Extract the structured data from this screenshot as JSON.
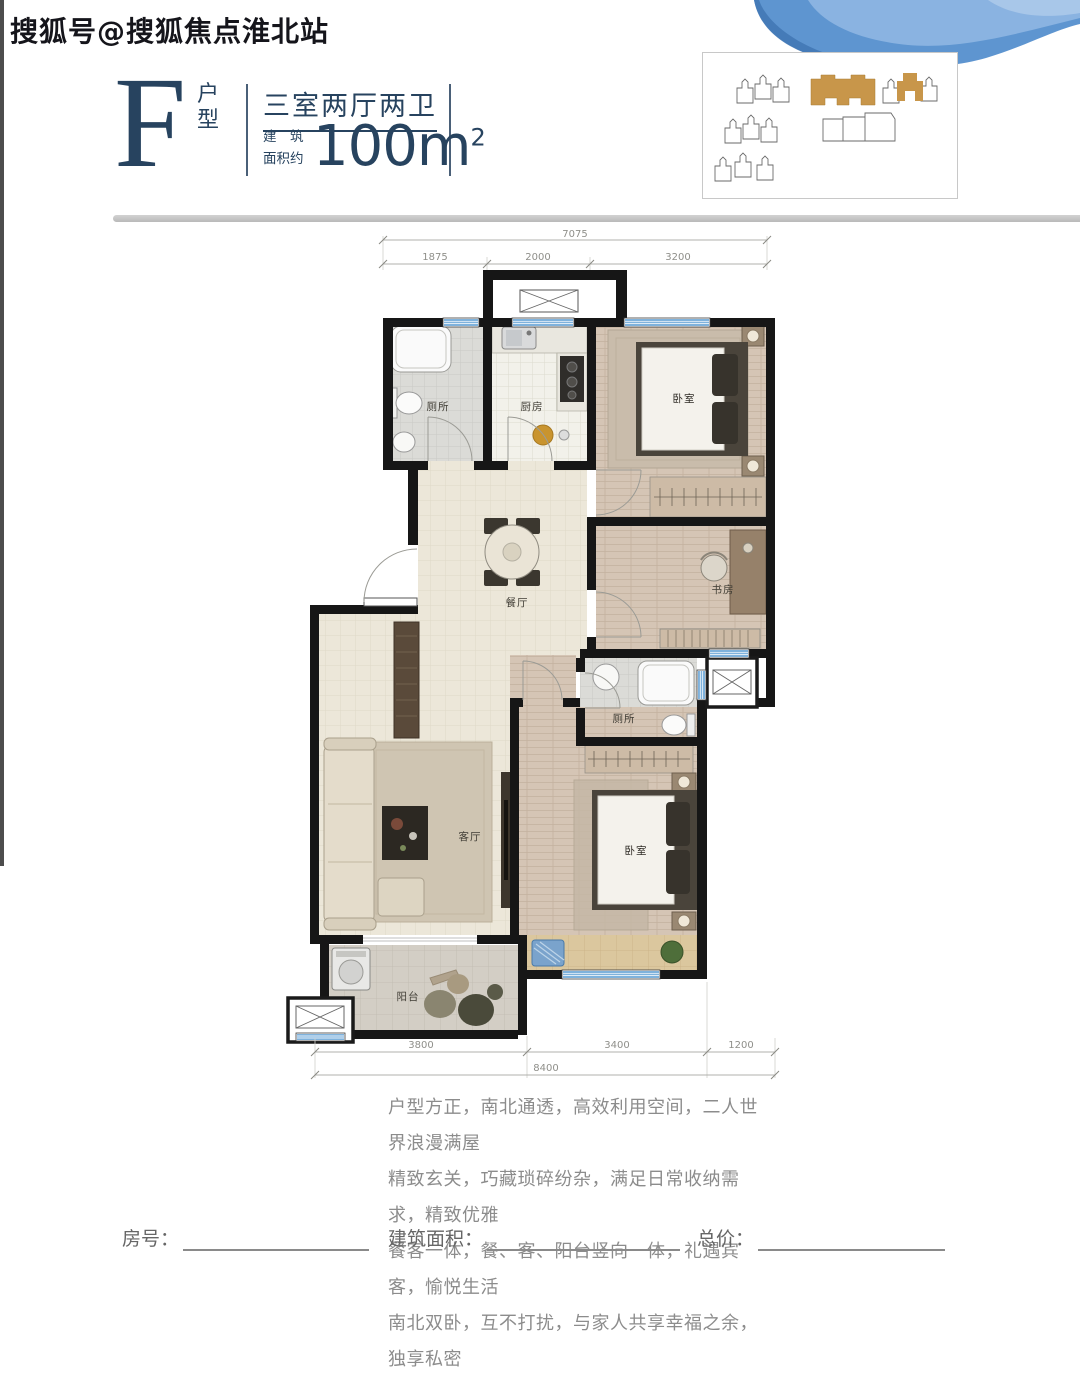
{
  "watermark": "搜狐号@搜狐焦点淮北站",
  "header": {
    "unit_letter": "F",
    "unit_type_label": "户型",
    "layout_title": "三室两厅两卫",
    "area_prefix_line1": "建　筑",
    "area_prefix_line2": "面积约",
    "area_value": "100m",
    "area_sup": "2"
  },
  "floor_plan": {
    "dims_top": {
      "total": "7075",
      "segments": [
        "1875",
        "2000",
        "3200"
      ]
    },
    "dims_bottom": {
      "segments": [
        "3800",
        "3400",
        "1200"
      ],
      "total": "8400"
    },
    "rooms": {
      "bath1": "厕所",
      "kitchen": "厨房",
      "bedroom1": "卧室",
      "dining": "餐厅",
      "study": "书房",
      "living": "客厅",
      "bath2": "厕所",
      "bedroom2": "卧室",
      "balcony": "阳台"
    }
  },
  "description": {
    "lines": [
      "户型方正，南北通透，高效利用空间，二人世界浪漫满屋",
      "精致玄关，巧藏琐碎纷杂，满足日常收纳需求，精致优雅",
      "餐客一体，餐、客、阳台竖向一体，礼遇宾客，愉悦生活",
      "南北双卧，互不打扰，与家人共享幸福之余，独享私密"
    ]
  },
  "footer": {
    "fields": [
      {
        "label": "房号："
      },
      {
        "label": "建筑面积："
      },
      {
        "label": "总价："
      }
    ]
  },
  "colors": {
    "navy": "#27435f",
    "gold": "#c8964a",
    "wall_black": "#161616",
    "window_blue": "#7fb2dc",
    "blob_blue": "#5e95d0",
    "text_gray": "#8c8c8c"
  }
}
